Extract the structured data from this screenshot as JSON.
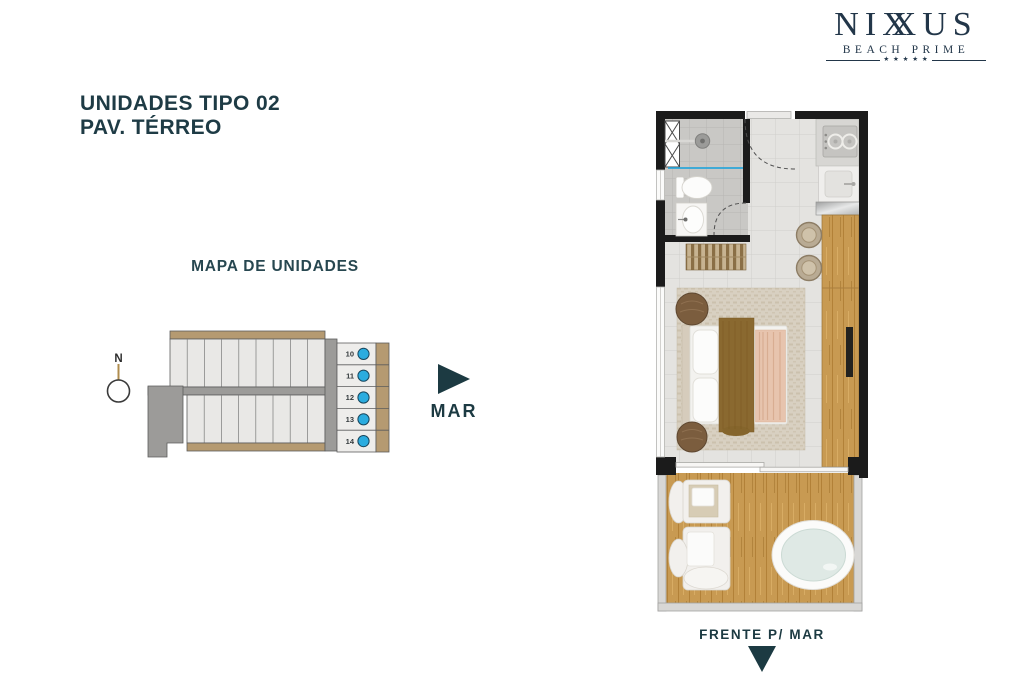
{
  "brand": {
    "name_prefix": "NI",
    "name_x1": "X",
    "name_x2": "X",
    "name_suffix": "US",
    "tagline": "BEACH PRIME",
    "stars": "★ ★ ★ ★ ★"
  },
  "title": {
    "line1": "UNIDADES TIPO 02",
    "line2": "PAV. TÉRREO"
  },
  "unit_map": {
    "heading": "MAPA DE UNIDADES",
    "compass_label": "N",
    "units": [
      {
        "label": "10"
      },
      {
        "label": "11"
      },
      {
        "label": "12"
      },
      {
        "label": "13"
      },
      {
        "label": "14"
      }
    ],
    "sea_label": "MAR"
  },
  "floor_plan": {
    "front_label": "FRENTE P/ MAR"
  },
  "colors": {
    "brand_navy": "#223649",
    "accent_teal": "#1e3b45",
    "unit_highlight_cyan": "#2bacdf",
    "map_tan": "#b59a71",
    "map_gray": "#9c9b99",
    "wall_black": "#1b1b1b",
    "wood": "#c89a52"
  }
}
